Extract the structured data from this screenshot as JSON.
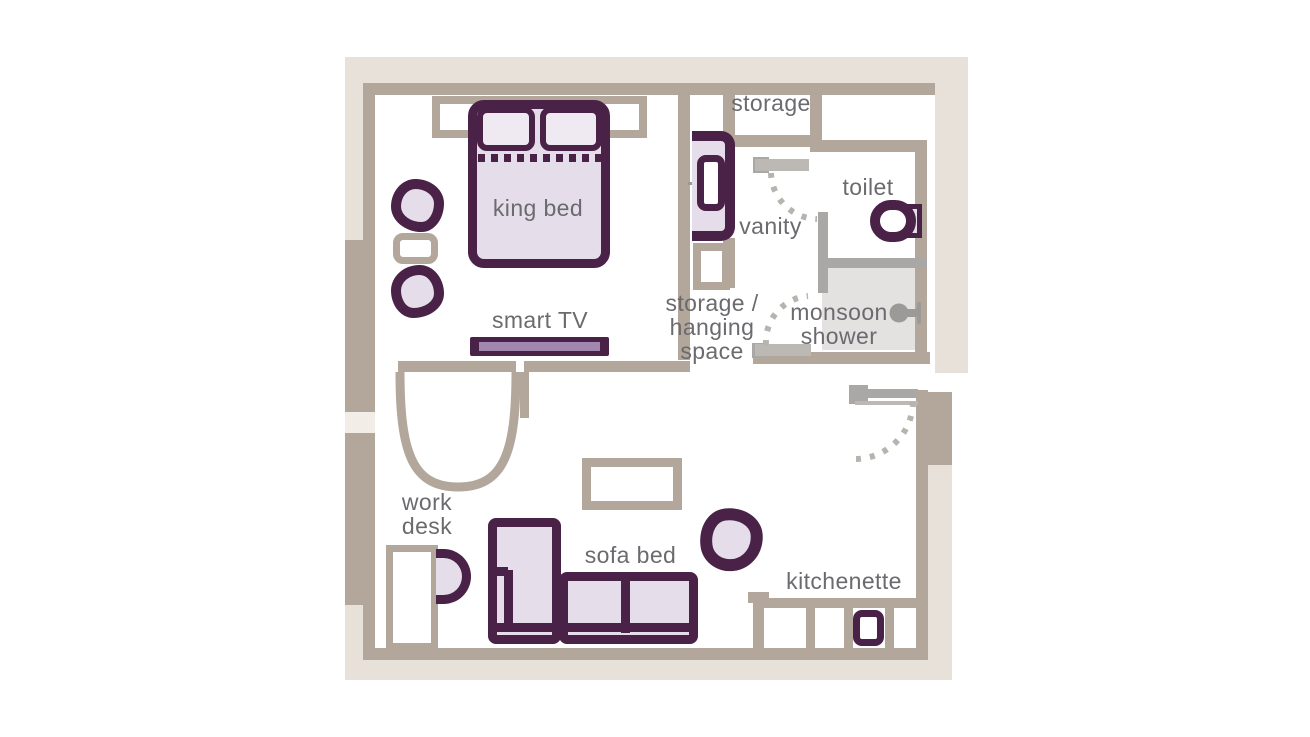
{
  "title": "studio room floor plan",
  "colors": {
    "purple": "#4a2147",
    "lavender": "#e5dde9",
    "pillow": "#efe9f2",
    "wall": "#b2a79a",
    "band": "#e7e1da",
    "band_light": "#f2ede7",
    "gray": "#a9a8a6",
    "gray_light": "#bcb8b3",
    "dot": "#b7b3ae",
    "shower_fill": "#e3e2e1",
    "shower_icon": "#9c9a97",
    "tv_screen": "#a288ae",
    "text": "#6b6a6e"
  },
  "labels": {
    "king_bed": "king bed",
    "smart_tv": "smart TV",
    "storage": "storage",
    "vanity": "vanity",
    "toilet": "toilet",
    "monsoon_shower": [
      "monsoon",
      "shower"
    ],
    "storage_hanging": [
      "storage /",
      "hanging",
      "space"
    ],
    "work_desk": [
      "work",
      "desk"
    ],
    "sofa_bed": "sofa bed",
    "kitchenette": "kitchenette"
  }
}
